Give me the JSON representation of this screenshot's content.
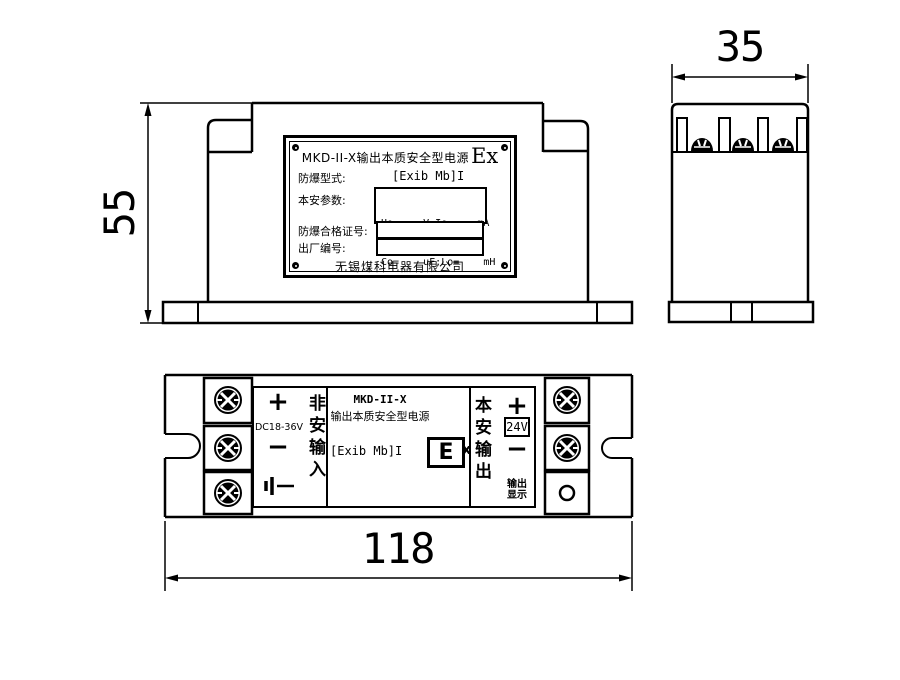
{
  "colors": {
    "line": "#000000",
    "background": "#ffffff"
  },
  "dimensions": {
    "height_mm": "55",
    "depth_mm": "35",
    "length_mm": "118"
  },
  "nameplate": {
    "title": "MKD-II-X输出本质安全型电源",
    "ex_mark": "Ex",
    "type_label": "防爆型式:",
    "type_value": "[Exib Mb]I",
    "params_label": "本安参数:",
    "params_line1": "Uo=    V;Io=    mA",
    "params_line2": "Co=    uF;Lo=    mH",
    "cert_label": "防爆合格证号:",
    "serial_label": "出厂编号:",
    "company": "无锡煤科电器有限公司"
  },
  "top_view": {
    "input": {
      "plus": "+",
      "rating": "DC18-36V",
      "minus": "−",
      "group_label": "非安输入"
    },
    "center": {
      "model": "MKD-II-X",
      "subtitle": "输出本质安全型电源",
      "ex_type": "[Exib Mb]I",
      "e_mark": "E",
      "x_mark": "x"
    },
    "output": {
      "group_label": "本安输出",
      "plus": "+",
      "voltage": "24V",
      "minus": "−",
      "led_label_line1": "输出",
      "led_label_line2": "显示"
    }
  }
}
